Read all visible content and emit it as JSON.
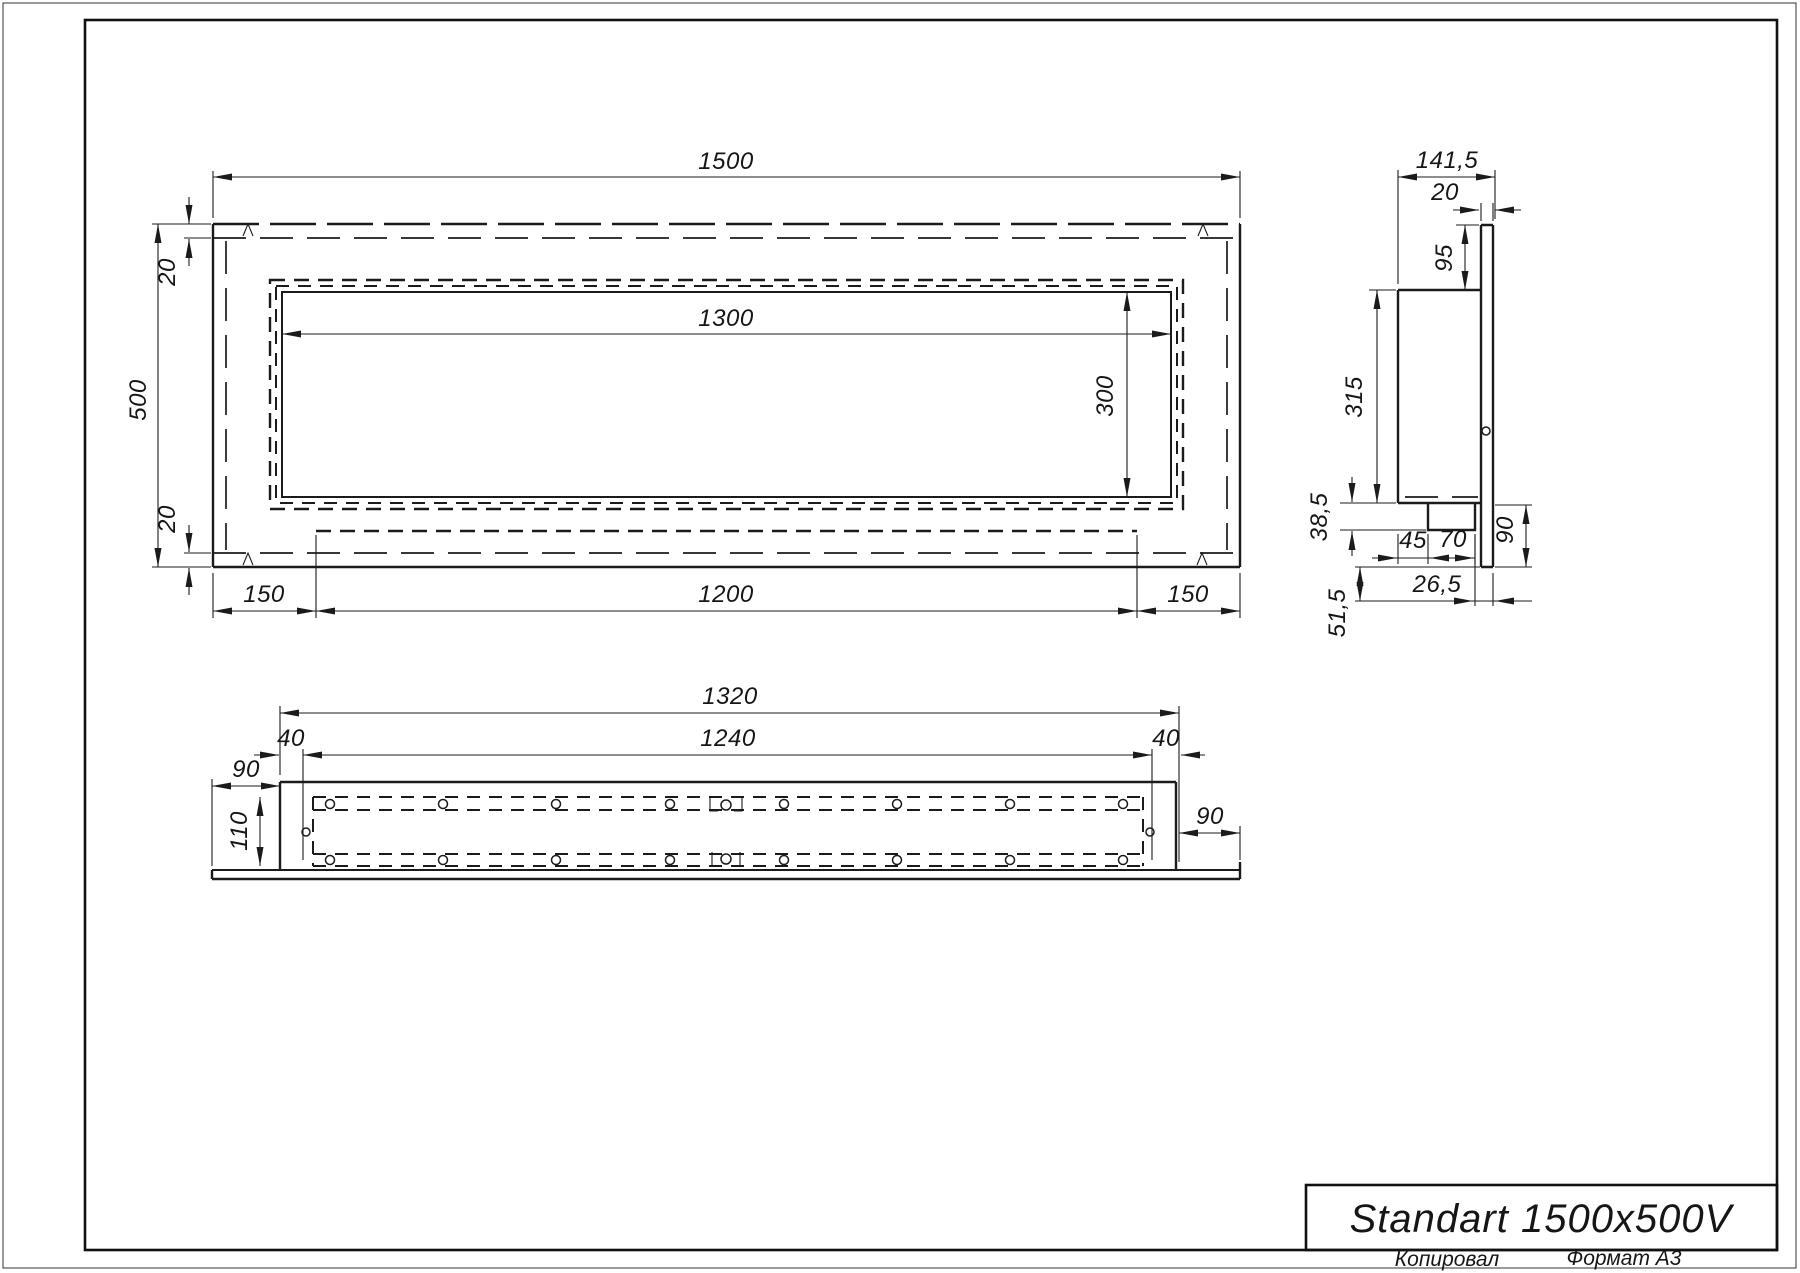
{
  "drawing": {
    "title": "Standart 1500x500V",
    "footer": {
      "copied": "Копировал",
      "format": "Формат А3"
    },
    "front_view": {
      "width": "1500",
      "height": "500",
      "flange_top": "20",
      "flange_bottom": "20",
      "opening_width": "1300",
      "opening_height": "300",
      "offset_left": "150",
      "tray_width": "1200",
      "offset_right": "150"
    },
    "side_view": {
      "depth": "141,5",
      "panel_thickness": "20",
      "top_inset": "95",
      "body_height": "315",
      "tray_height": "38,5",
      "tray_offset": "45",
      "tray_depth": "70",
      "bracket_height": "90",
      "rear_gap": "26,5",
      "bottom_drop": "51,5"
    },
    "bottom_view": {
      "outer_width": "1320",
      "inner_width": "1240",
      "inset_left": "40",
      "inset_right": "40",
      "overhang_left": "90",
      "depth": "110",
      "overhang_right": "90"
    }
  }
}
